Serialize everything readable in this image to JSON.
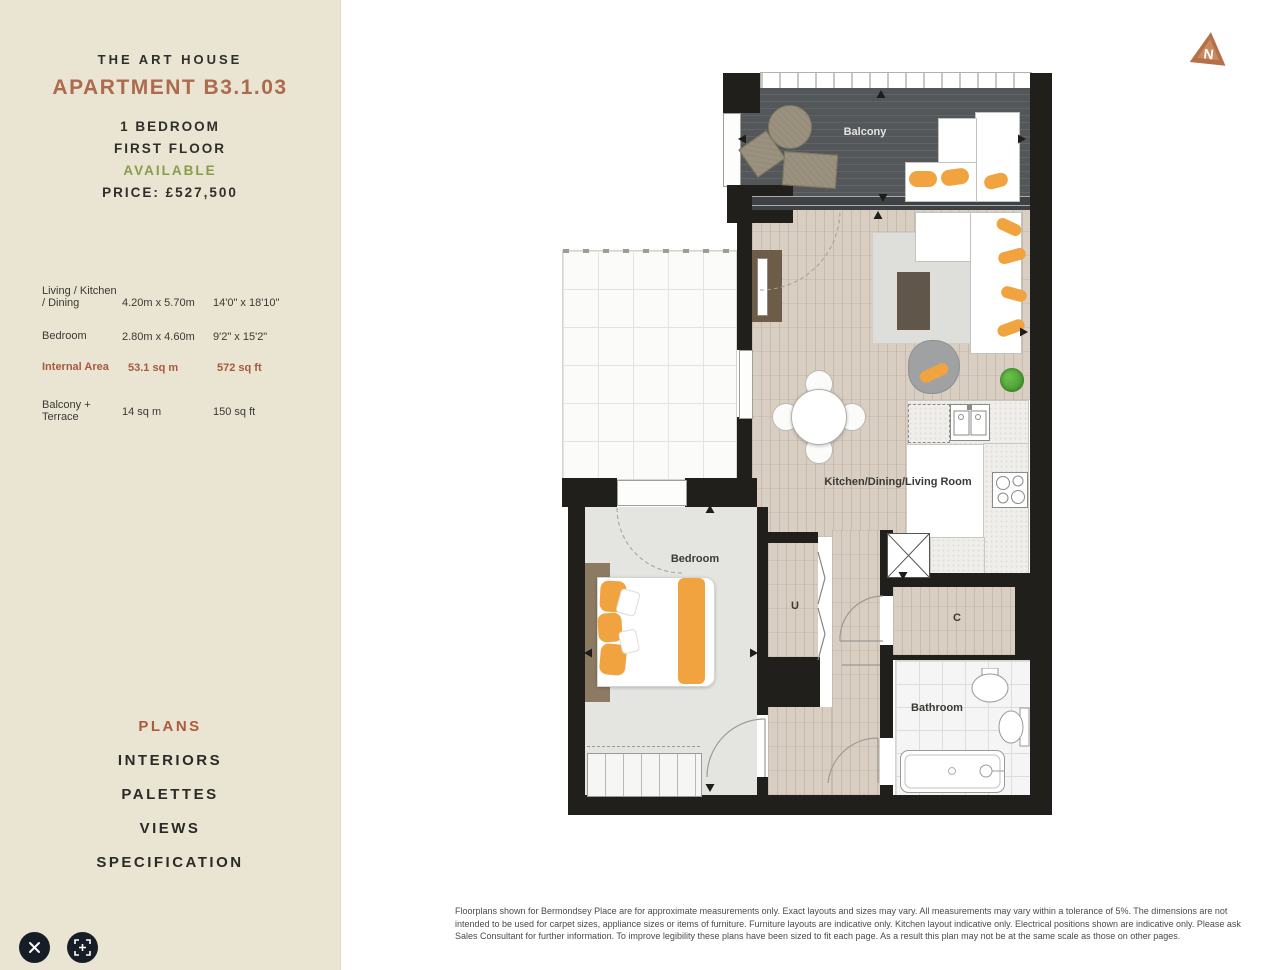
{
  "sidebar": {
    "development": "THE ART HOUSE",
    "apartment": "APARTMENT B3.1.03",
    "bedrooms": "1 BEDROOM",
    "floor": "FIRST FLOOR",
    "status": "AVAILABLE",
    "price": "PRICE: £527,500",
    "dimensions": [
      {
        "label": "Living / Kitchen / Dining",
        "metric": "4.20m x 5.70m",
        "imperial": "14'0\" x 18'10\""
      },
      {
        "label": "Bedroom",
        "metric": "2.80m x 4.60m",
        "imperial": "9'2\" x 15'2\""
      },
      {
        "label": "Internal Area",
        "metric": "53.1 sq m",
        "imperial": "572 sq ft"
      },
      {
        "label": "Balcony + Terrace",
        "metric": "14 sq m",
        "imperial": "150 sq ft"
      }
    ],
    "nav": [
      {
        "label": "PLANS",
        "active": true
      },
      {
        "label": "INTERIORS",
        "active": false
      },
      {
        "label": "PALETTES",
        "active": false
      },
      {
        "label": "VIEWS",
        "active": false
      },
      {
        "label": "SPECIFICATION",
        "active": false
      }
    ],
    "icons": {
      "close": "close-icon",
      "zoom": "zoom-in-icon"
    }
  },
  "plan": {
    "labels": {
      "balcony": "Balcony",
      "living": "Kitchen/Dining/Living Room",
      "bedroom": "Bedroom",
      "bathroom": "Bathroom",
      "utility": "U",
      "cupboard": "C"
    }
  },
  "brand": {
    "logo_letter": "N"
  },
  "footer": {
    "disclaimer": "Floorplans shown for Bermondsey Place are for approximate measurements only. Exact layouts and sizes may vary. All measurements may vary within a tolerance of 5%. The dimensions are not intended to be used for carpet sizes, appliance sizes or items of furniture. Furniture layouts are indicative only. Kitchen layout indicative only. Electrical positions shown are indicative only. Please ask Sales Consultant for further information. To improve legibility these plans have been sized to fit each page. As a result this plan may not be at the same scale as those on other pages."
  },
  "colors": {
    "sidebar_bg": "#e9e5d2",
    "accent_terracotta": "#ad6a4d",
    "available_green": "#8a9b4a",
    "wall_black": "#211f1c",
    "deck_grey": "#54575a",
    "wood_floor": "#d8cec1",
    "furniture_orange": "#f0a33f"
  }
}
